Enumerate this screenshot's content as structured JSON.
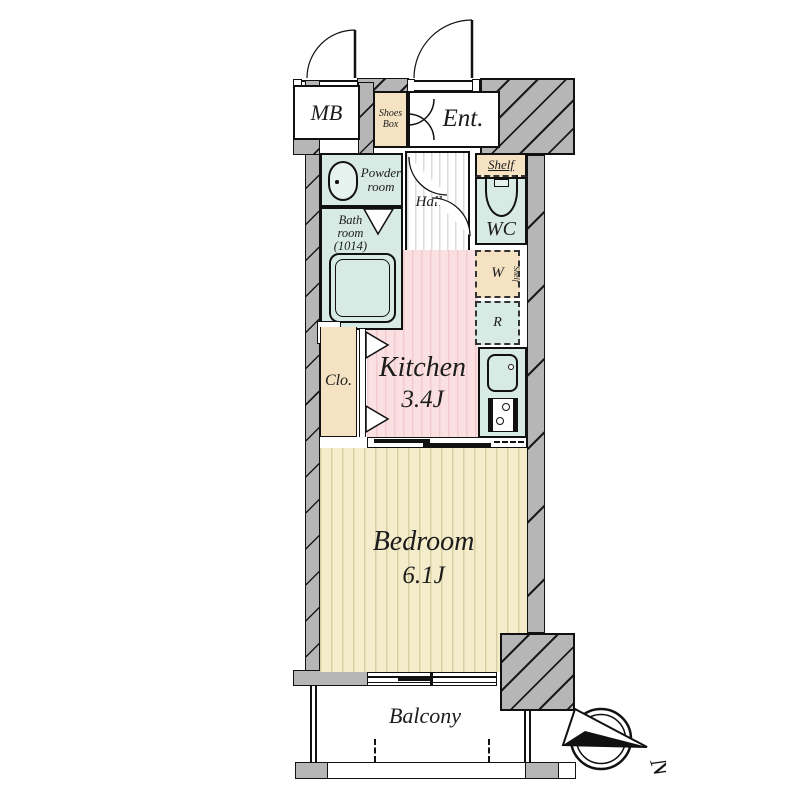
{
  "colors": {
    "wall_gray": "#b6b6b6",
    "wet_area_teal": "#d7eae4",
    "storage_tan": "#f4e2c3",
    "kitchen_pink": "#fae0e1",
    "bedroom_beige": "#f4ecca",
    "line_black": "#111111"
  },
  "rooms": {
    "mb": {
      "label": "MB"
    },
    "shoes_box": {
      "line1": "Shoes",
      "line2": "Box"
    },
    "entrance": {
      "label": "Ent."
    },
    "powder_room": {
      "line1": "Powder",
      "line2": "room"
    },
    "hall": {
      "label": "Hall"
    },
    "wc": {
      "label": "WC",
      "shelf_label": "Shelf"
    },
    "bath_room": {
      "line1": "Bath",
      "line2": "room",
      "line3": "(1014)"
    },
    "pipe_space": {
      "label": "PS"
    },
    "closet": {
      "label": "Clo."
    },
    "washer": {
      "label": "W",
      "shelf_label": "Shelf"
    },
    "refrigerator": {
      "label": "R"
    },
    "kitchen": {
      "name": "Kitchen",
      "size": "3.4J"
    },
    "bedroom": {
      "name": "Bedroom",
      "size": "6.1J"
    },
    "balcony": {
      "label": "Balcony"
    }
  },
  "compass": {
    "north_label": "N"
  }
}
